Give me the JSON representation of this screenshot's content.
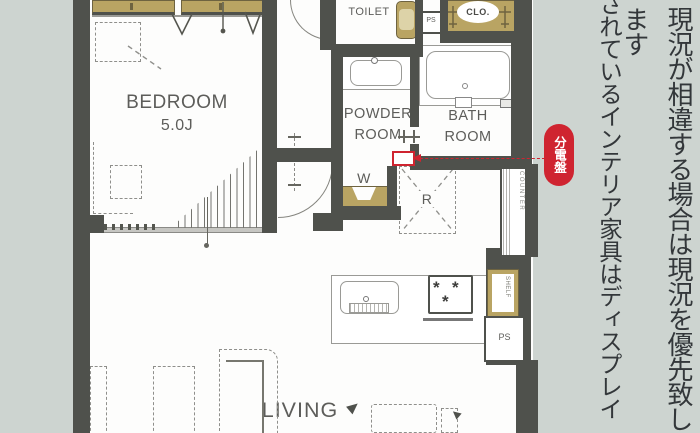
{
  "plan": {
    "bedroom": {
      "name": "BEDROOM",
      "size": "5.0J"
    },
    "toilet_label": "TOILET",
    "powder_room": {
      "line1": "POWDER",
      "line2": "ROOM"
    },
    "bath_room": {
      "line1": "BATH",
      "line2": "ROOM"
    },
    "living_label": "LIVING",
    "closet_label": "CLO.",
    "washer_label": "W",
    "fridge_label": "R",
    "ps_upper_label": "PS",
    "ps_lower_label": "PS",
    "shelf_label": "SHELF",
    "counter_label": "COUNTER",
    "stove_burner_symbol": "*"
  },
  "annotation": {
    "badge_label": "分電盤",
    "badge_color": "#cf2430"
  },
  "side_text": {
    "right_column": "現況が相違する場合は現況を優先致します",
    "left_column": "されているインテリア家具はディスプレイ"
  },
  "colors": {
    "background": "#cdd4d0",
    "wall": "#4f514c",
    "tan": "#b9a463",
    "red": "#cf2430",
    "plan_text": "#5d5d5a"
  }
}
